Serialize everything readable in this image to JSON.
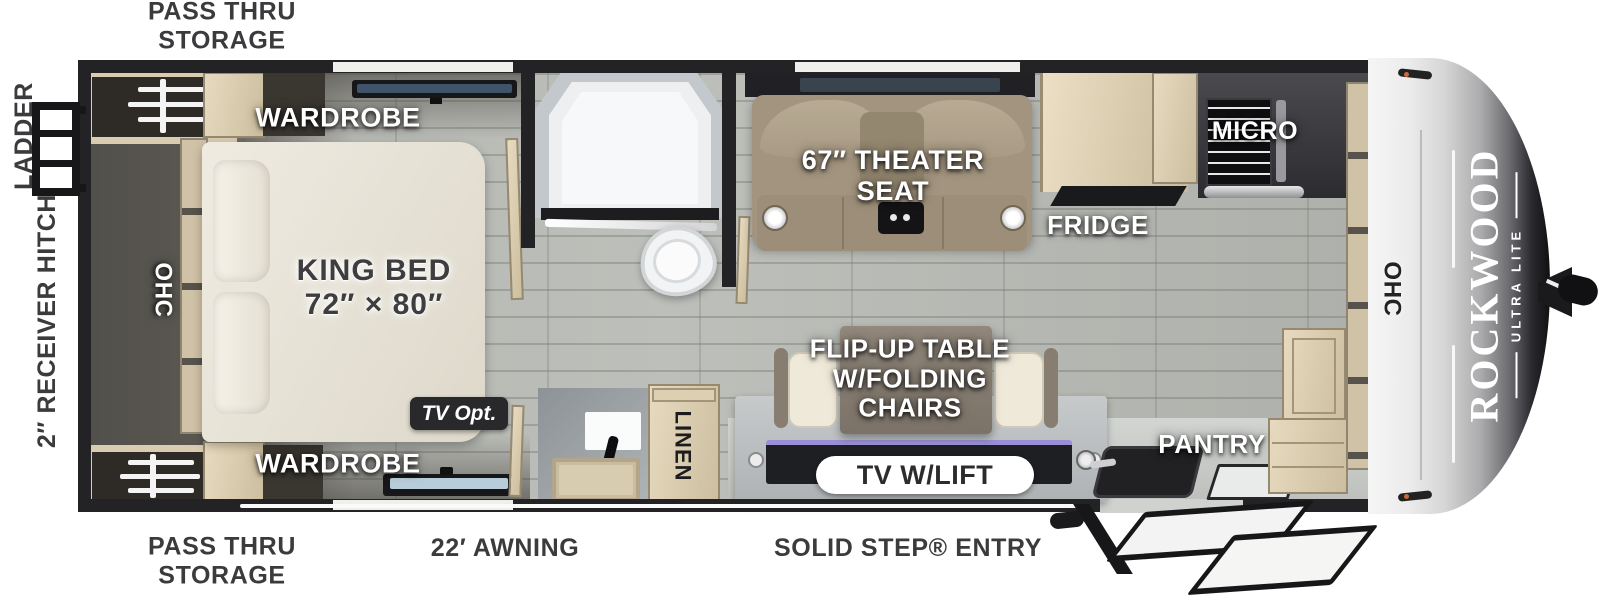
{
  "brand": {
    "name": "ROCKWOOD",
    "sub": "ULTRA LITE"
  },
  "exterior": {
    "pass_thru_top": "PASS THRU\nSTORAGE",
    "pass_thru_bottom": "PASS THRU\nSTORAGE",
    "ladder": "LADDER",
    "hitch": "2″ RECEIVER HITCH",
    "awning": "22′ AWNING",
    "entry": "SOLID STEP® ENTRY"
  },
  "bedroom": {
    "wardrobe_top": "WARDROBE",
    "wardrobe_bottom": "WARDROBE",
    "bed": "KING BED\n72″ × 80″",
    "ohc": "OHC",
    "tv_opt": "TV Opt."
  },
  "bath": {
    "linen": "LINEN"
  },
  "living": {
    "theater": "67″ THEATER\nSEAT",
    "flip_table": "FLIP-UP TABLE\nW/FOLDING\nCHAIRS",
    "tv_lift": "TV W/LIFT"
  },
  "kitchen": {
    "fridge": "FRIDGE",
    "micro": "MICRO",
    "pantry": "PANTRY",
    "ohc": "OHC"
  },
  "colors": {
    "floor": "#b6b8b3",
    "wall": "#232326",
    "cabinet_wood": "#d6c9ac",
    "theater_seat": "#a2947e",
    "front_cap_silver": "#d6d6d6",
    "label_white": "#ffffff",
    "label_dark": "#3b3b3d"
  }
}
